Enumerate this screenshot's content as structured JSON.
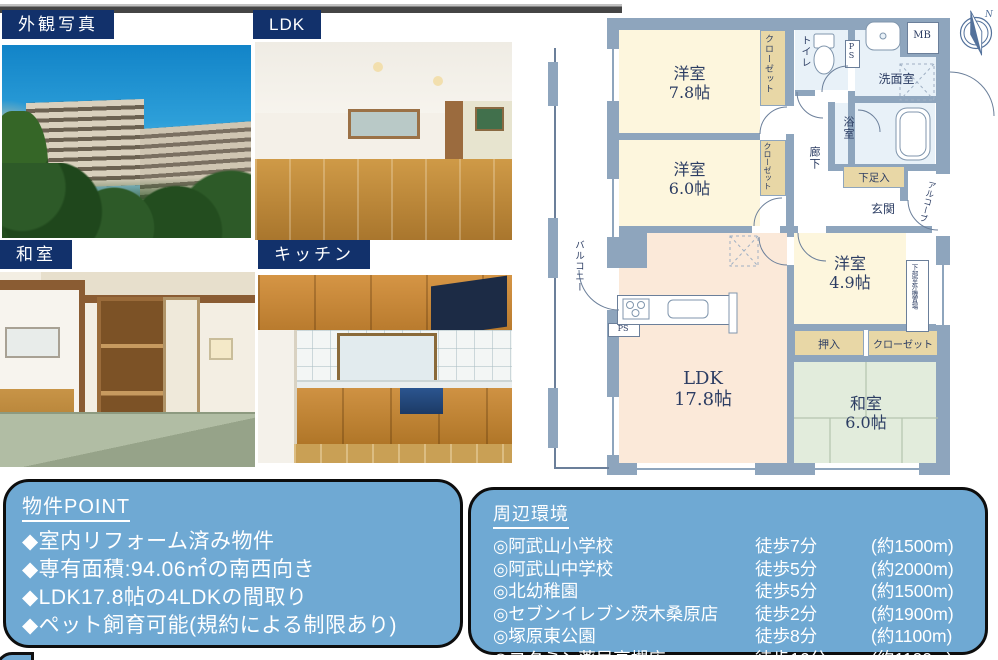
{
  "photos": [
    {
      "label": "外観写真"
    },
    {
      "label": "LDK"
    },
    {
      "label": "和室"
    },
    {
      "label": "キッチン"
    }
  ],
  "floorplan": {
    "north_label": "N",
    "rooms": [
      {
        "name": "洋室",
        "size": "7.8帖"
      },
      {
        "name": "洋室",
        "size": "6.0帖"
      },
      {
        "name": "洋室",
        "size": "4.9帖"
      },
      {
        "name": "LDK",
        "size": "17.8帖"
      },
      {
        "name": "和室",
        "size": "6.0帖"
      }
    ],
    "labels": {
      "closet1": "クローゼット",
      "closet2": "クローゼット",
      "closet3": "クローゼット",
      "toilet": "トイレ",
      "ps": "PS",
      "washroom": "洗面室",
      "mb": "MB",
      "bath": "浴室",
      "hallway": "廊下",
      "shoebox": "下足入",
      "entrance": "玄関",
      "alcove": "アルコーブ",
      "oshiire": "押入",
      "outdoor_unit": "下部室外機置場",
      "balcony": "バルコニー"
    }
  },
  "property_point": {
    "title": "物件POINT",
    "items": [
      "◆室内リフォーム済み物件",
      "◆専有面積:94.06㎡の南西向き",
      "◆LDK17.8帖の4LDKの間取り",
      "◆ペット飼育可能(規約による制限あり)"
    ]
  },
  "surroundings": {
    "title": "周辺環境",
    "rows": [
      {
        "name": "◎阿武山小学校",
        "walk": "徒歩7分",
        "dist": "(約1500m)"
      },
      {
        "name": "◎阿武山中学校",
        "walk": "徒歩5分",
        "dist": "(約2000m)"
      },
      {
        "name": "◎北幼稚園",
        "walk": "徒歩5分",
        "dist": "(約1500m)"
      },
      {
        "name": "◎セブンイレブン茨木桑原店",
        "walk": "徒歩2分",
        "dist": "(約1900m)"
      },
      {
        "name": "◎塚原東公園",
        "walk": "徒歩8分",
        "dist": "(約1100m)"
      },
      {
        "name": "◎コクミン薬局高槻店",
        "walk": "徒歩16分",
        "dist": "(約1100m)"
      }
    ]
  },
  "colors": {
    "label_navy": "#12316b",
    "box_blue": "#6fa9d3",
    "wall_gray_blue": "#8ea5bd",
    "room_cream": "#fdf6dd",
    "room_peach": "#fbe9d9",
    "room_water": "#e8f1f8",
    "room_tatami": "#e2ecdc",
    "closet_tan": "#e8d7a6"
  }
}
